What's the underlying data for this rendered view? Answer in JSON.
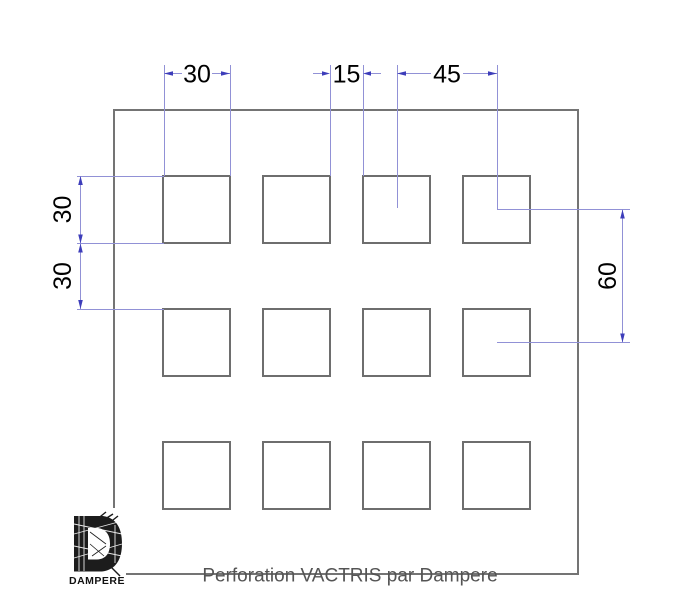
{
  "drawing": {
    "caption": "Perforation VACTRIS par Dampere",
    "dimensions": {
      "hole_width": "30",
      "horizontal_gap": "15",
      "horizontal_pitch": "45",
      "hole_height": "30",
      "vertical_gap": "30",
      "vertical_pitch": "60"
    },
    "logo": {
      "letter": "D",
      "name": "DAMPERE"
    },
    "colors": {
      "outline_gray": "#747474",
      "dimension_line_blue": "#9191d6",
      "arrow_blue": "#3d3dba",
      "dimension_text": "#000000",
      "caption_gray": "#545454"
    }
  }
}
